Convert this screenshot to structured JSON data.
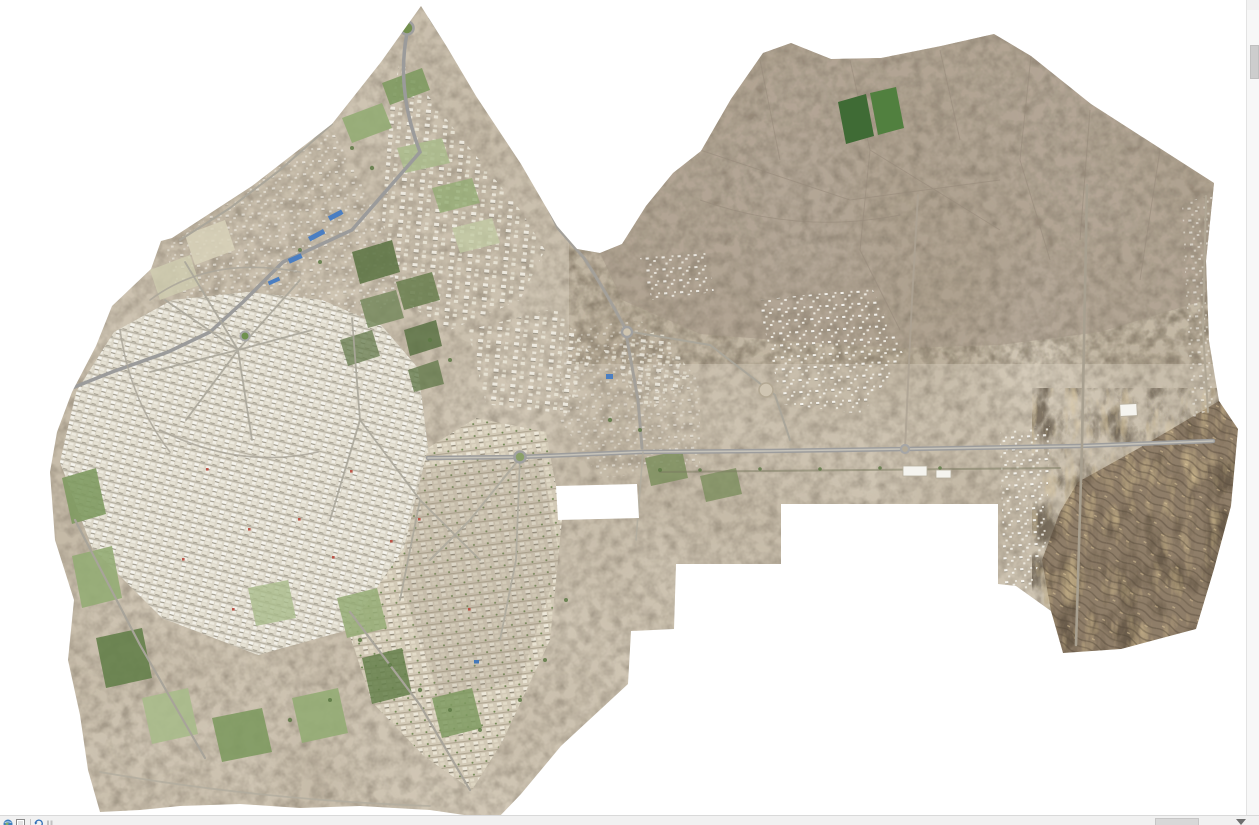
{
  "window": {
    "background_color": "#ffffff",
    "title": "GIS map view - aerial orthomosaic"
  },
  "map": {
    "title": "Aerial orthomosaic of a desert city with farmland, desert plain and dark rocky hills",
    "type": "orthophoto-mosaic",
    "regions": [
      {
        "name": "northern-triangle-suburbs"
      },
      {
        "name": "northwest-field-band"
      },
      {
        "name": "western-dense-city"
      },
      {
        "name": "south-central-city"
      },
      {
        "name": "central-construction-zone"
      },
      {
        "name": "eastern-housing-clusters"
      },
      {
        "name": "northeast-gray-farmland"
      },
      {
        "name": "eastern-desert-plain"
      },
      {
        "name": "southeast-dark-hills"
      },
      {
        "name": "eastern-settlement-strip"
      },
      {
        "name": "green-farm-fields"
      },
      {
        "name": "main-east-west-highway"
      }
    ],
    "colors": {
      "terrain_base": "#d7cdbc",
      "desert_gray_brown": "#b4a798",
      "dark_hills": "#8e7d67",
      "urban_light": "#e3dfd4",
      "vegetation_green": "#7e9a60",
      "dark_field_green": "#3f6b35",
      "road_gray": "#a3a3a3",
      "blue_roof": "#4a7ec2"
    }
  },
  "scrollbars": {
    "vertical": {
      "track_color": "#f7f7f7",
      "thumb_color": "#cdcdcd",
      "thumb_top_px": 45,
      "thumb_height_px": 34
    },
    "horizontal": {
      "track_color": "#f1f1f1",
      "thumb_color": "#d8d8d8",
      "thumb_left_px": 1155,
      "thumb_width_px": 44
    }
  },
  "statusbar": {
    "icons": [
      {
        "name": "globe-data-view-icon"
      },
      {
        "name": "page-layout-view-icon"
      },
      {
        "name": "refresh-icon"
      },
      {
        "name": "pause-drawing-icon"
      }
    ]
  }
}
